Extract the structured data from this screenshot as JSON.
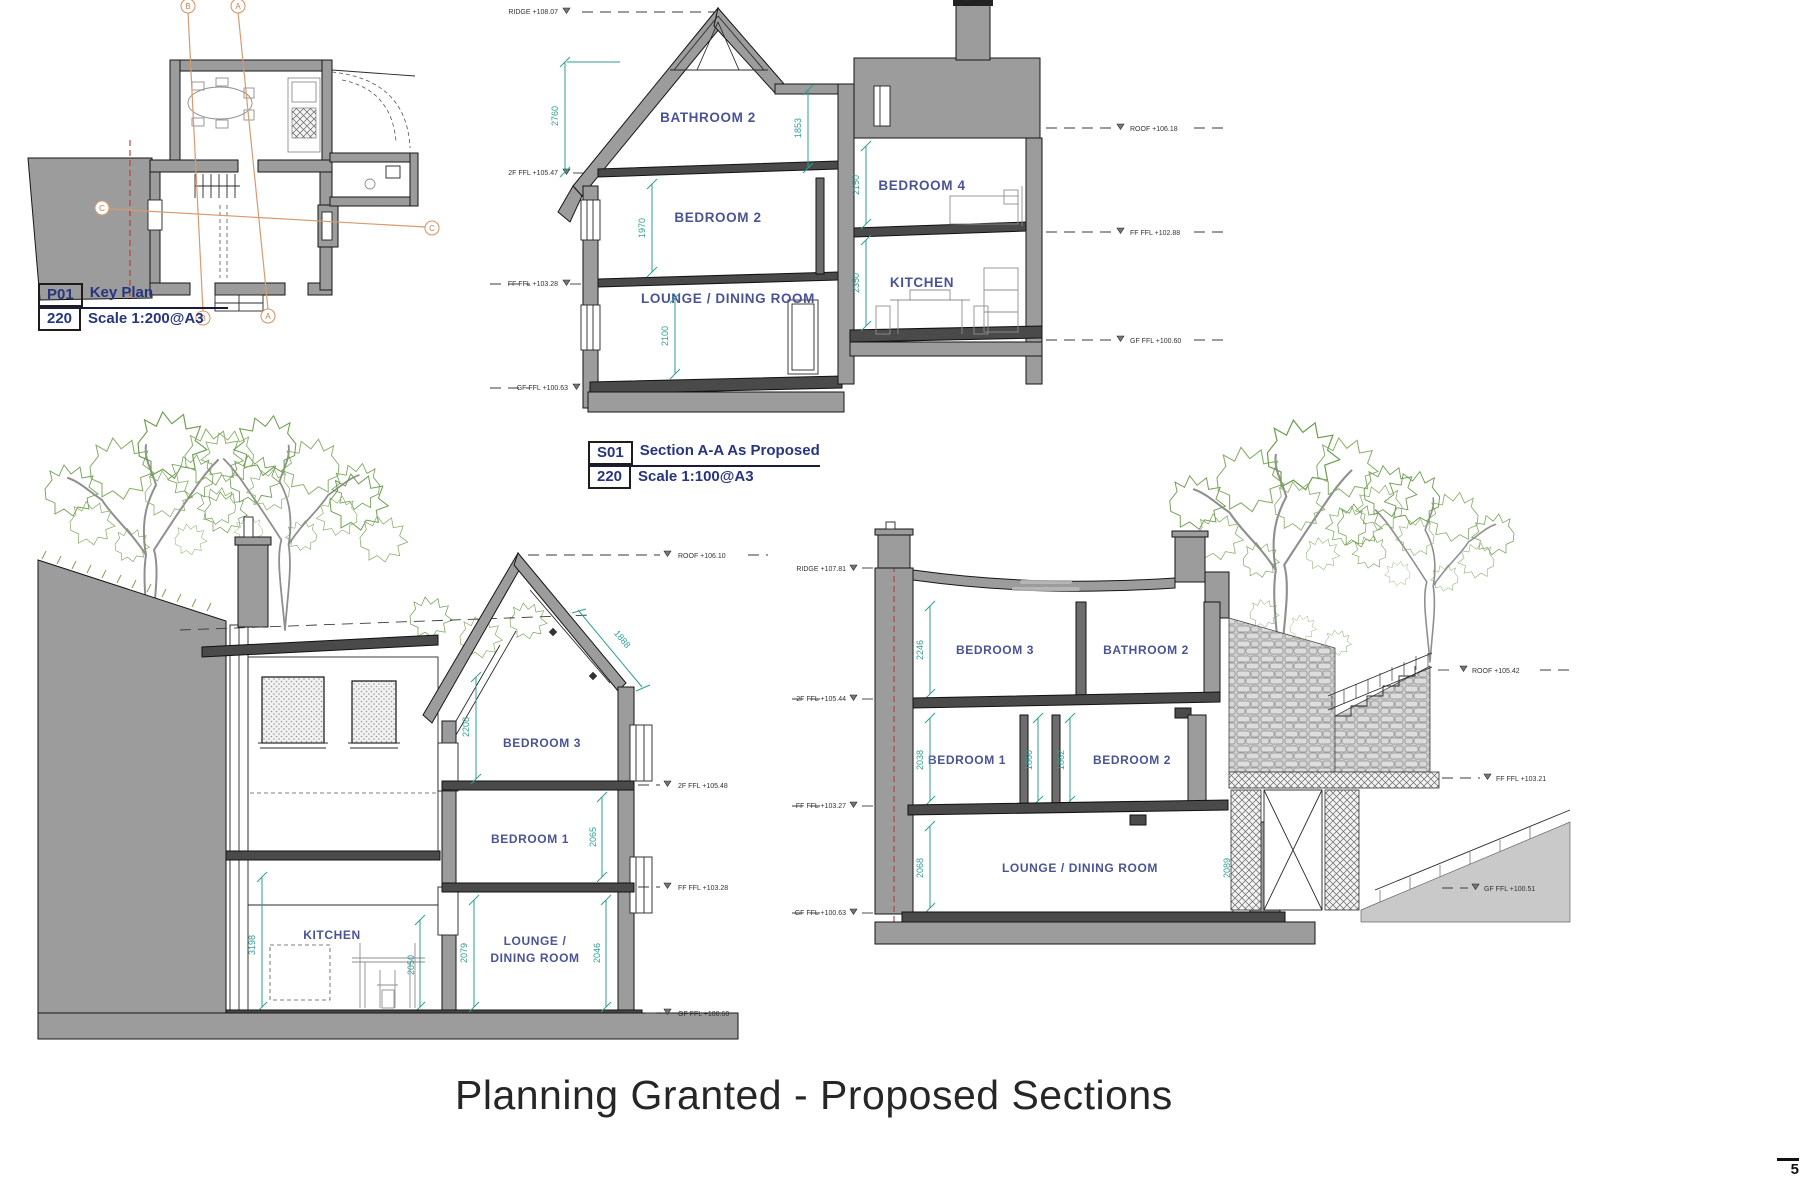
{
  "colors": {
    "wall_gray": "#9c9c9c",
    "line_dark": "#1c1c1c",
    "room_label_blue": "#4a5494",
    "dim_teal": "#2f9e98",
    "title_navy": "#27357f",
    "section_line_orange": "#d89a6e",
    "centerline_red": "#b23a2e",
    "tree_green": "#6f9e52",
    "title_text": "#262626"
  },
  "page": {
    "title": "Planning Granted - Proposed Sections",
    "corner_mark": "5"
  },
  "key_plan": {
    "ref": "P01",
    "sheet": "220",
    "name": "Key Plan",
    "scale": "Scale 1:200@A3",
    "markers": {
      "a": "A",
      "b": "B",
      "c": "C"
    }
  },
  "section_aa": {
    "ref": "S01",
    "sheet": "220",
    "name": "Section A-A As Proposed",
    "scale": "Scale 1:100@A3",
    "rooms": {
      "bathroom2": "BATHROOM 2",
      "bedroom2": "BEDROOM 2",
      "lounge": "LOUNGE / DINING ROOM",
      "bedroom4": "BEDROOM 4",
      "kitchen": "KITCHEN"
    },
    "dims": {
      "roof": "2760",
      "bathroom2": "1853",
      "bedroom2": "1970",
      "lounge": "2100",
      "bedroom4": "2150",
      "kitchen": "2350"
    },
    "levels_left": [
      {
        "label": "RIDGE +108.07"
      },
      {
        "label": "2F FFL +105.47"
      },
      {
        "label": "FF FFL +103.28"
      },
      {
        "label": "GF FFL +100.63"
      }
    ],
    "levels_right": [
      {
        "label": "ROOF +106.18"
      },
      {
        "label": "FF FFL +102.88"
      },
      {
        "label": "GF FFL +100.60"
      }
    ]
  },
  "section_b": {
    "rooms": {
      "bedroom3": "BEDROOM 3",
      "bedroom1": "BEDROOM 1",
      "kitchen": "KITCHEN",
      "lounge_line1": "LOUNGE /",
      "lounge_line2": "DINING ROOM"
    },
    "dims": {
      "bedroom3": "2208",
      "bedroom3_slope": "1888",
      "bedroom1": "2065",
      "kitchen_left": "3198",
      "kitchen_right": "2050",
      "lounge_left": "2079",
      "lounge_right": "2046"
    },
    "levels_right": [
      {
        "label": "ROOF +106.10"
      },
      {
        "label": "2F FFL +105.48"
      },
      {
        "label": "FF FFL +103.28"
      },
      {
        "label": "GF FFL +100.60"
      }
    ]
  },
  "section_c": {
    "rooms": {
      "bedroom3": "BEDROOM 3",
      "bathroom2": "BATHROOM 2",
      "bedroom1": "BEDROOM 1",
      "bedroom2": "BEDROOM 2",
      "lounge": "LOUNGE / DINING ROOM"
    },
    "dims": {
      "bedroom3": "2246",
      "bedroom1": "2038",
      "between": "1860",
      "bedroom2": "1862",
      "lounge_left": "2068",
      "lounge_right": "2089"
    },
    "levels_left": [
      {
        "label": "RIDGE +107.81"
      },
      {
        "label": "2F FFL +105.44"
      },
      {
        "label": "FF FFL +103.27"
      },
      {
        "label": "GF FFL +100.63"
      }
    ],
    "levels_right": [
      {
        "label": "ROOF +105.42"
      },
      {
        "label": "FF FFL +103.21"
      },
      {
        "label": "GF FFL +100.51"
      }
    ]
  }
}
